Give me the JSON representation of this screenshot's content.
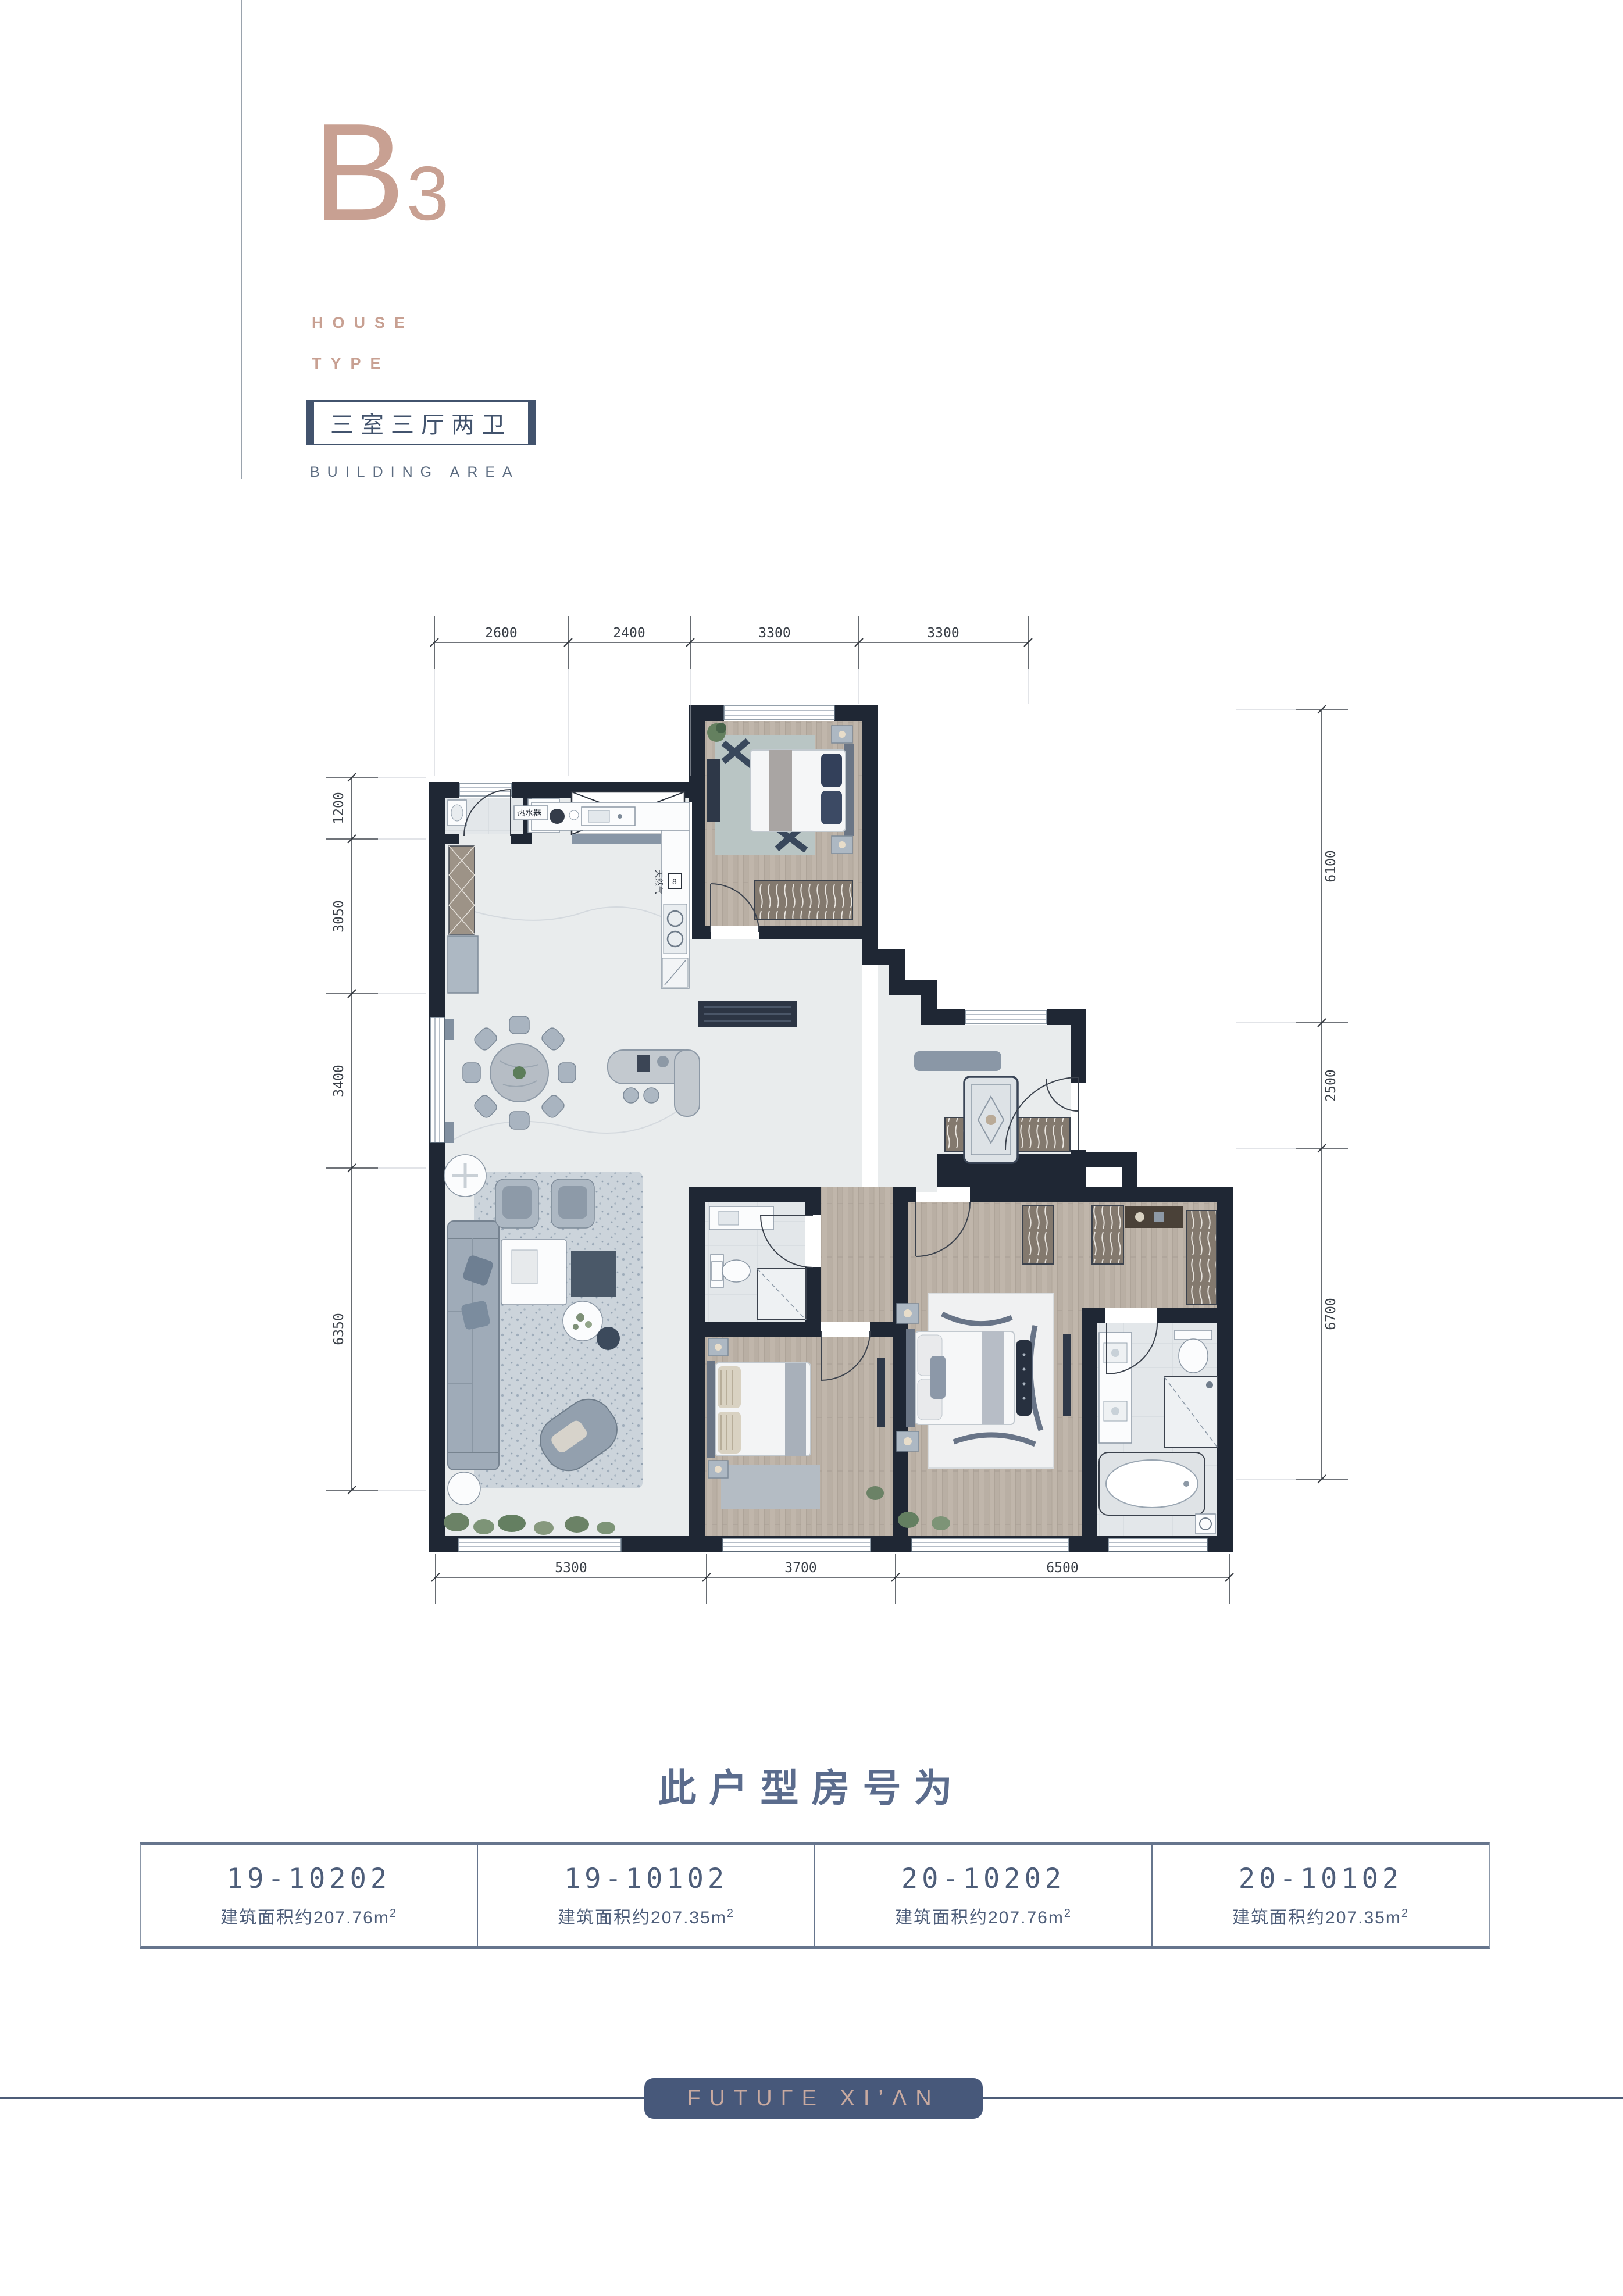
{
  "colors": {
    "accent_tan": "#c8a092",
    "slate": "#4e5e7a",
    "wall": "#1f2734",
    "badge_bg": "#47587a"
  },
  "header": {
    "unit_letter": "B",
    "unit_number": "3",
    "subtitle_line1": "HOUSE",
    "subtitle_line2": "TYPE",
    "layout_label": "三室三厅两卫",
    "area_label": "BUILDING AREA"
  },
  "plan": {
    "dims": {
      "top": [
        "2600",
        "2400",
        "3300",
        "3300"
      ],
      "bottom": [
        "5300",
        "3700",
        "6500"
      ],
      "left": [
        "1200",
        "3050",
        "3400",
        "6350"
      ],
      "right": [
        "6100",
        "2500",
        "6700"
      ]
    },
    "labels": {
      "water_heater": "热水器",
      "gas": "天然气",
      "gas_meter": "8"
    }
  },
  "section": {
    "title": "此户型房号为"
  },
  "table": {
    "cells": [
      {
        "room": "19-10202",
        "area_prefix": "建筑面积约207.76m",
        "area_sup": "2"
      },
      {
        "room": "19-10102",
        "area_prefix": "建筑面积约207.35m",
        "area_sup": "2"
      },
      {
        "room": "20-10202",
        "area_prefix": "建筑面积约207.76m",
        "area_sup": "2"
      },
      {
        "room": "20-10102",
        "area_prefix": "建筑面积约207.35m",
        "area_sup": "2"
      }
    ]
  },
  "footer": {
    "logo": "FUTUΓE XI’ΛN"
  }
}
